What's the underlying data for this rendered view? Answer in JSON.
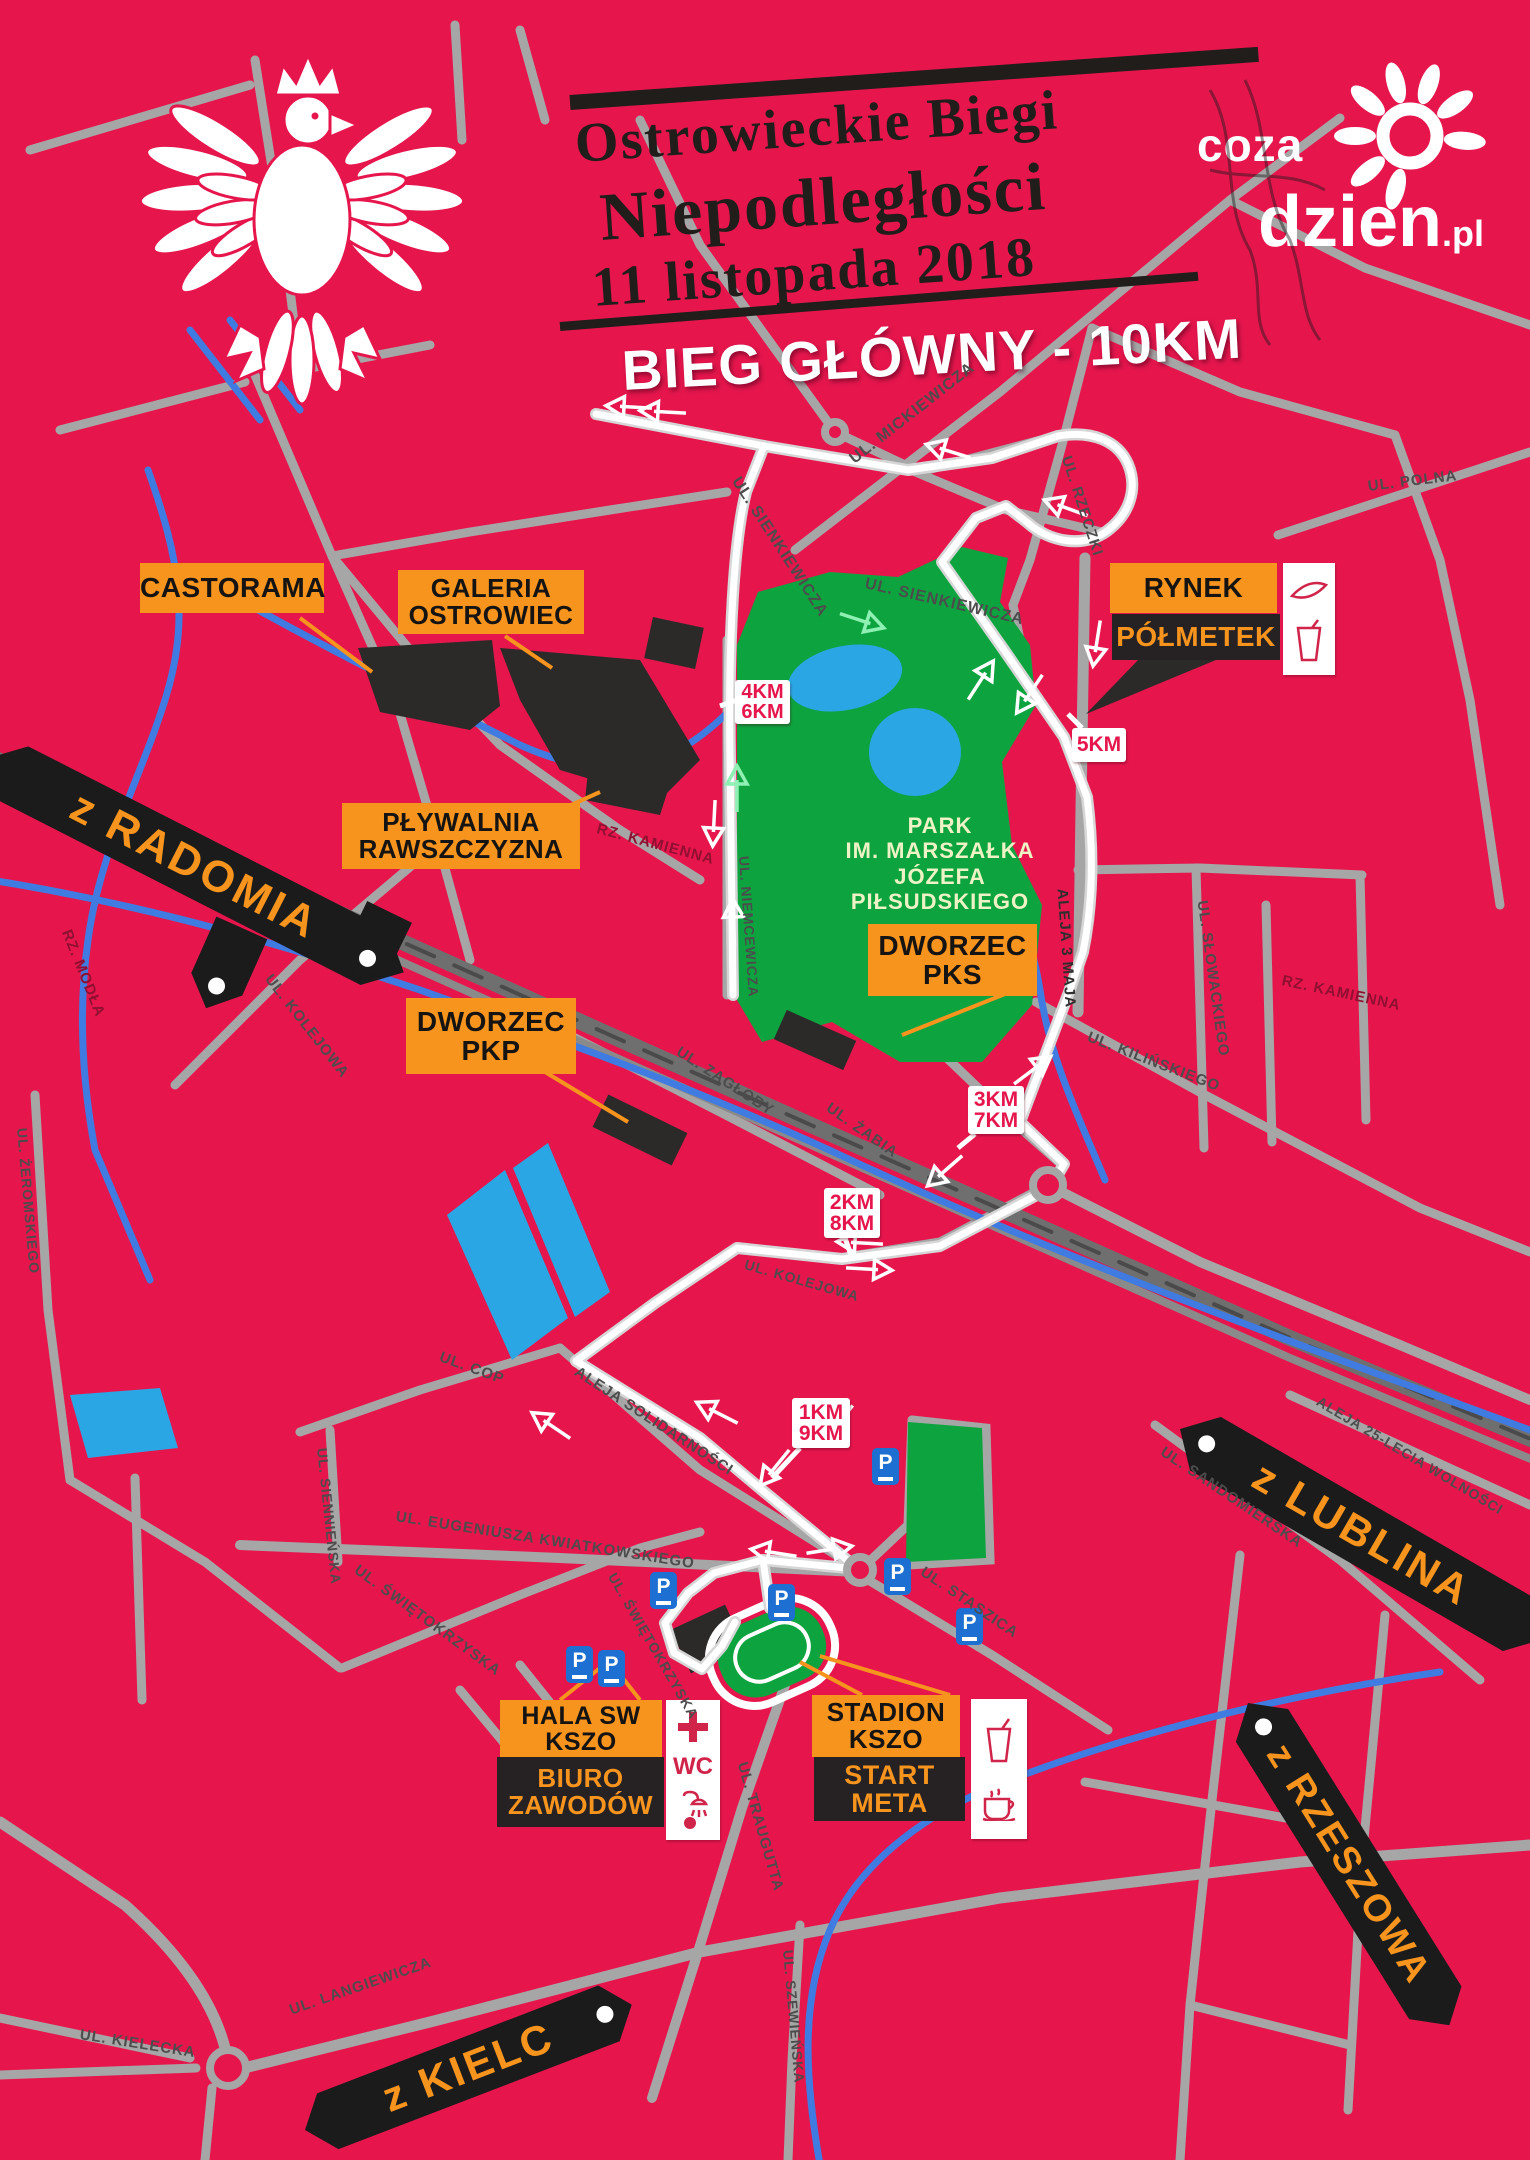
{
  "header": {
    "title_line1": "Ostrowieckie Biegi",
    "title_line2": "Niepodległości",
    "title_line3": "11 listopada 2018",
    "race_label": "BIEG GŁÓWNY - 10KM"
  },
  "logo": {
    "top": "coza",
    "main": "dzien",
    "suffix": ".pl"
  },
  "poi": {
    "castorama": "CASTORAMA",
    "galeria": [
      "GALERIA",
      "OSTROWIEC"
    ],
    "plywalnia": [
      "PŁYWALNIA",
      "RAWSZCZYZNA"
    ],
    "dworzec_pkp": [
      "DWORZEC",
      "PKP"
    ],
    "dworzec_pks": [
      "DWORZEC",
      "PKS"
    ],
    "rynek": "RYNEK",
    "polmetek": "PÓŁMETEK",
    "hala": [
      "HALA SW",
      "KSZO"
    ],
    "biuro": [
      "BIURO",
      "ZAWODÓW"
    ],
    "stadion": [
      "STADION",
      "KSZO"
    ],
    "start_meta": [
      "START",
      "META"
    ],
    "wc": "WC"
  },
  "park_label": [
    "PARK",
    "IM. MARSZAŁKA",
    "JÓZEFA PIŁSUDSKIEGO"
  ],
  "km_markers": [
    [
      "4KM",
      "6KM"
    ],
    [
      "5KM"
    ],
    [
      "3KM",
      "7KM"
    ],
    [
      "2KM",
      "8KM"
    ],
    [
      "1KM",
      "9KM"
    ]
  ],
  "banners": [
    "z RADOMIA",
    "z LUBLINA",
    "z RZESZOWA",
    "z KIELC"
  ],
  "parking_label": "P",
  "streets": [
    {
      "name": "UL. SIENKIEWICZA"
    },
    {
      "name": "UL. MICKIEWICZA"
    },
    {
      "name": "UL. RZECZKI"
    },
    {
      "name": "UL. SIENKIEWICZA"
    },
    {
      "name": "UL. POLNA"
    },
    {
      "name": "ALEJA 3 MAJA"
    },
    {
      "name": "UL. SŁOWACKIEGO"
    },
    {
      "name": "UL. KILIŃSKIEGO"
    },
    {
      "name": "RZ. KAMIENNA"
    },
    {
      "name": "RZ. KAMIENNA"
    },
    {
      "name": "UL. ZAGŁOBY"
    },
    {
      "name": "UL. ŻABIA"
    },
    {
      "name": "UL. KOLEJOWA"
    },
    {
      "name": "RZ. MODŁA"
    },
    {
      "name": "UL. ŻEROMSKIEGO"
    },
    {
      "name": "UL. COP"
    },
    {
      "name": "ALEJA SOLIDARNOŚCI"
    },
    {
      "name": "UL. KOLEJOWA"
    },
    {
      "name": "UL. EUGENIUSZA KWIATKOWSKIEGO"
    },
    {
      "name": "UL. ŚWIĘTOKRZYSKA"
    },
    {
      "name": "UL. ŚWIĘTOKRZYSKA"
    },
    {
      "name": "UL. STASZICA"
    },
    {
      "name": "UL. TRAUGUTTA"
    },
    {
      "name": "UL. SZEWIEŃSKA"
    },
    {
      "name": "UL. LANGIEWICZA"
    },
    {
      "name": "UL. KIELECKA"
    },
    {
      "name": "UL. SANDOMIERSKA"
    },
    {
      "name": "ALEJA 25-LECIA WOLNOŚCI"
    },
    {
      "name": "UL. NIEMCEWICZA"
    },
    {
      "name": "UL. SIENNIEŃSKA"
    }
  ],
  "colors": {
    "background": "#e6164d",
    "road": "#a6a6a6",
    "railway": "#6f6f6f",
    "water_area": "#2aa6e4",
    "river": "#3f7be0",
    "park": "#0da33f",
    "accent_orange": "#f7941e",
    "label_black": "#262223",
    "route": "#ffffff",
    "km_red": "#e6164d",
    "parking_blue": "#1d6fd1"
  }
}
